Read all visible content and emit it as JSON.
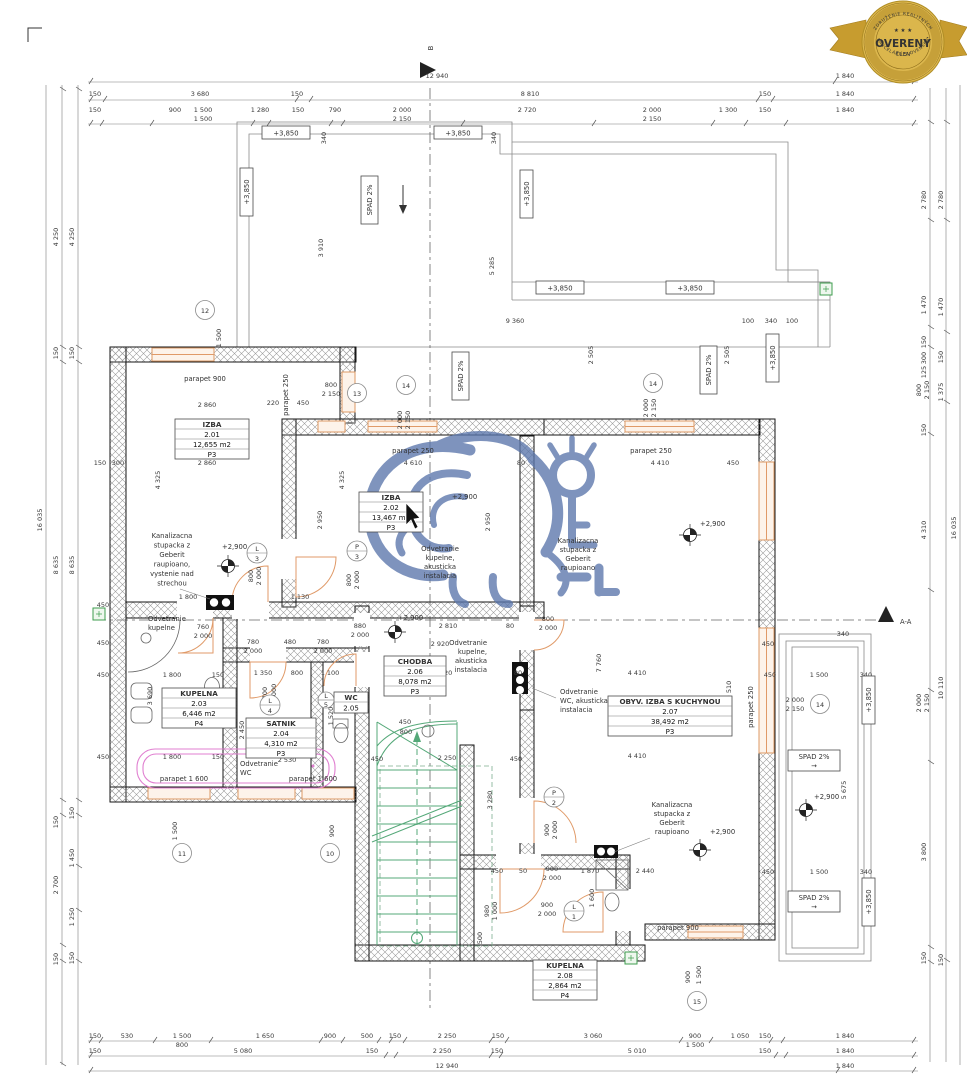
{
  "badge": {
    "arc_top": "ZDRUŽENIE REALITNÝCH",
    "arc_bottom": "KANCELÁRIÍ SLOVENSKA",
    "stars": "★ ★ ★",
    "title": "OVERENÝ",
    "subtitle": "ČLEN"
  },
  "markers": {
    "section_b": "B",
    "section_aa": "A-A"
  },
  "rooms": [
    {
      "name": "IZBA",
      "num": "2.01",
      "area": "12,655 m2",
      "floor": "P3"
    },
    {
      "name": "IZBA",
      "num": "2.02",
      "area": "13,467 m2",
      "floor": "P3"
    },
    {
      "name": "KUPELNA",
      "num": "2.03",
      "area": "6,446 m2",
      "floor": "P4"
    },
    {
      "name": "SATNIK",
      "num": "2.04",
      "area": "4,310 m2",
      "floor": "P3"
    },
    {
      "name": "WC",
      "num": "2.05"
    },
    {
      "name": "CHODBA",
      "num": "2.06",
      "area": "8,078 m2",
      "floor": "P3"
    },
    {
      "name": "OBYV. IZBA S KUCHYNOU",
      "num": "2.07",
      "area": "38,492 m2",
      "floor": "P3"
    },
    {
      "name": "KUPELNA",
      "num": "2.08",
      "area": "2,864 m2",
      "floor": "P4"
    }
  ],
  "levels": {
    "roof": "+3,850",
    "ceiling": "+2,900"
  },
  "slope": {
    "label": "SPAD 2%",
    "arrow": "→"
  },
  "parapets": {
    "p900": "parapet 900",
    "p250": "parapet 250",
    "p1600": "parapet 1 600"
  },
  "notes": {
    "kanal_left": [
      "Kanalizacna",
      "stupacka z",
      "Geberit",
      "raupioano,",
      "vystenie nad",
      "strechou"
    ],
    "kanal_short": [
      "Kanalizacna",
      "stupacka z",
      "Geberit",
      "raupioano"
    ],
    "odv_kupelna": [
      "Odvetranie",
      "kupelne"
    ],
    "odv_kupelna_ak": [
      "Odvetranie",
      "kupelne,",
      "akusticka",
      "instalacia"
    ],
    "odv_wc": [
      "Odvetranie",
      "WC"
    ],
    "odv_wc_ak": [
      "Odvetranie",
      "WC, akusticka",
      "instalacia"
    ]
  },
  "bubbles": {
    "b10": "10",
    "b11": "11",
    "b12": "12",
    "b13": "13",
    "b14": "14",
    "b15": "15"
  },
  "doors": {
    "p3": [
      "P",
      "3"
    ],
    "p2": [
      "P",
      "2"
    ],
    "l1": [
      "L",
      "1"
    ],
    "l3": [
      "L",
      "3"
    ],
    "l4": [
      "L",
      "4"
    ],
    "l5": [
      "L",
      "5"
    ]
  },
  "dims": {
    "top1": [
      "12 940",
      "1 840"
    ],
    "top2": [
      "150",
      "3 680",
      "150",
      "8 810",
      "150",
      "1 840"
    ],
    "top3": [
      "150",
      "900",
      "1 500",
      "1 500",
      "1 280",
      "150",
      "790",
      "2 000",
      "2 150",
      "2 720",
      "2 000",
      "2 150",
      "1 300",
      "150",
      "1 840"
    ],
    "bot1": [
      "150",
      "530",
      "1 500",
      "800",
      "1 650",
      "900",
      "500",
      "150",
      "2 250",
      "150",
      "3 060",
      "900",
      "1 500",
      "1 050",
      "150",
      "1 840"
    ],
    "bot2": [
      "150",
      "5 080",
      "150",
      "2 250",
      "150",
      "5 010",
      "150",
      "1 840"
    ],
    "bot3": [
      "12 940",
      "1 840"
    ],
    "left1": [
      "16 035"
    ],
    "left2": [
      "4 250",
      "150",
      "8 635",
      "150",
      "2 700",
      "150"
    ],
    "left3": [
      "4 250",
      "150",
      "8 635",
      "150",
      "1 450",
      "1 250",
      "150"
    ],
    "right1": [
      "16 035",
      "10 110"
    ],
    "right2": [
      "2 780",
      "1 470",
      "150",
      "1 375",
      "150"
    ],
    "right3": [
      "2 780",
      "1 470",
      "150",
      "300",
      "125",
      "800",
      "2 150",
      "150",
      "4 310",
      "2 000",
      "2 150",
      "3 800",
      "150"
    ],
    "terrace": [
      "3 910",
      "5 285",
      "340",
      "340",
      "9 360",
      "100",
      "340",
      "100",
      "2 505",
      "2 505",
      "1 500"
    ],
    "inner": [
      "2 860",
      "220",
      "450",
      "800",
      "2 150",
      "2 860",
      "4 325",
      "4 325",
      "2 950",
      "2 950",
      "4 610",
      "80",
      "150",
      "300",
      "450",
      "4 410",
      "450",
      "1 800",
      "1 130",
      "880",
      "2 000",
      "2 810",
      "80",
      "800",
      "2 000",
      "2 920",
      "2 920",
      "80",
      "780",
      "2 000",
      "480",
      "780",
      "2 000",
      "1 350",
      "800",
      "1 100",
      "1 800",
      "150",
      "1 800",
      "150",
      "2 450",
      "2 530",
      "700",
      "2 000",
      "3 690",
      "450",
      "450",
      "450",
      "760",
      "2 000",
      "450",
      "2 250",
      "450",
      "3 280",
      "450",
      "800",
      "450",
      "50",
      "900",
      "2 000",
      "1 870",
      "2 440",
      "900",
      "2 000",
      "4 410",
      "4 410",
      "9 510",
      "7 760",
      "450",
      "340",
      "450",
      "1 500",
      "340",
      "450",
      "1 500",
      "340",
      "5 675",
      "2 000",
      "2 150",
      "900",
      "1 500",
      "1 600",
      "980",
      "1 000",
      "500",
      "900",
      "1 500",
      "800",
      "2 000",
      "800",
      "2 000",
      "2 000",
      "2 150",
      "2 000",
      "2 150",
      "900",
      "2 000",
      "1 520"
    ]
  }
}
